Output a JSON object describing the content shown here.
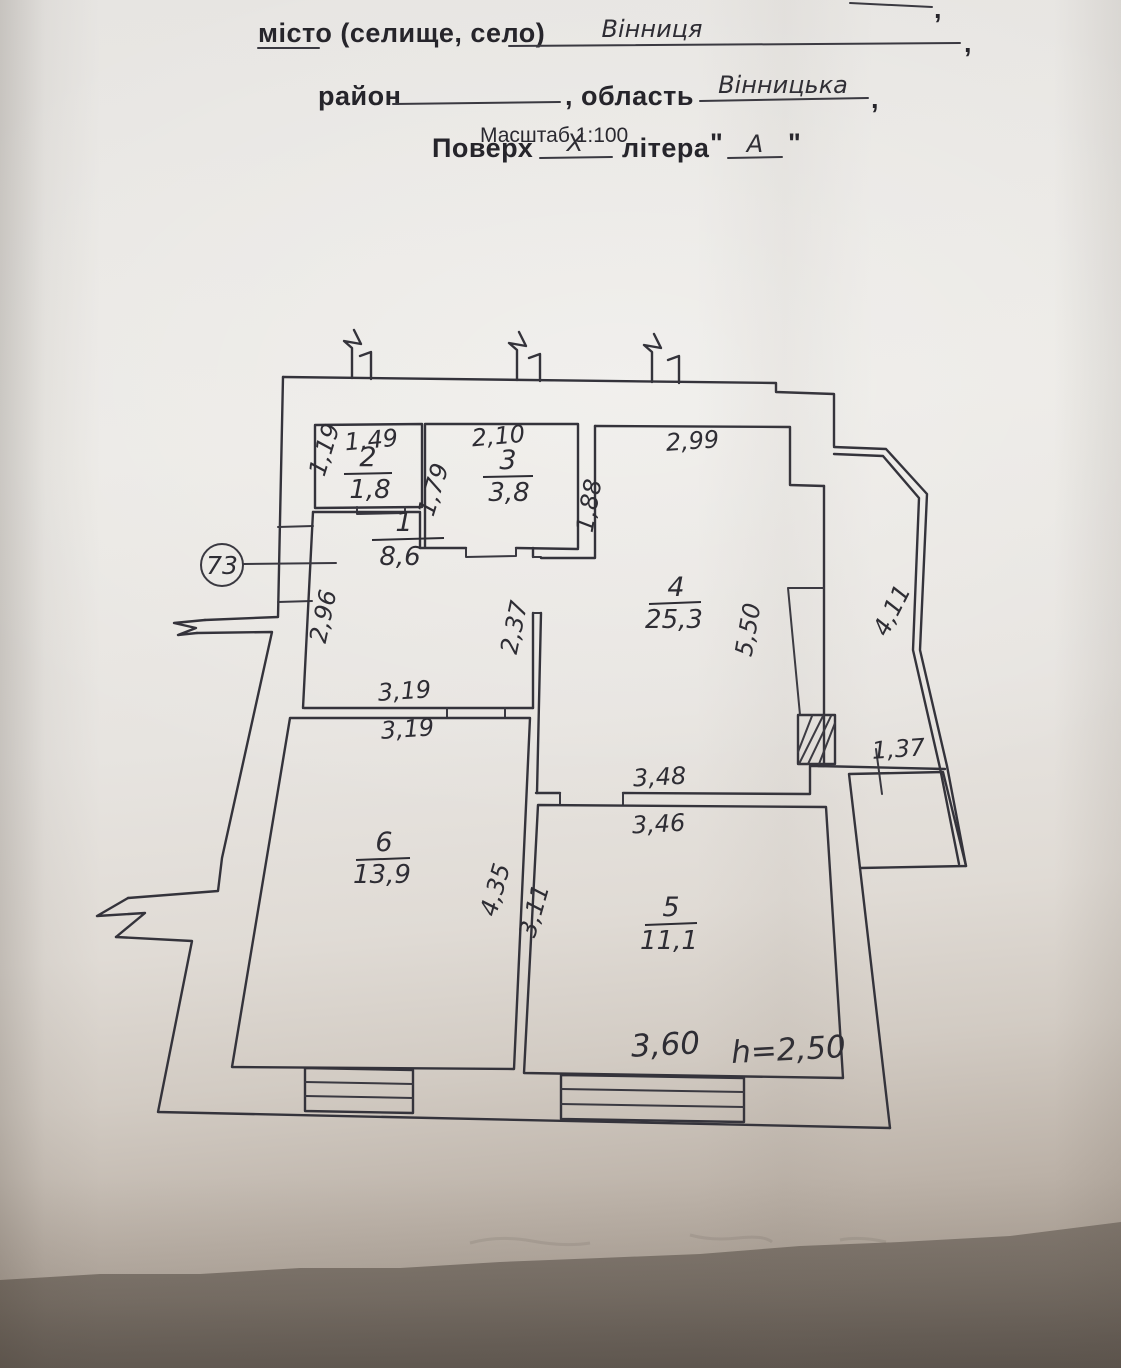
{
  "header": {
    "top_partial_comma": ",",
    "city_label": "місто (селище, село)",
    "city_value": "Вінниця",
    "comma_1": ",",
    "district_label": "район",
    "region_label": ", область",
    "region_value": "Вінницька",
    "comma_2": ",",
    "scale_note": "Масштаб 1:100",
    "floor_label": "Поверх",
    "floor_value": "X",
    "letter_label": "літера",
    "open_quote": "\"",
    "letter_value": "А",
    "close_quote": "\""
  },
  "plan": {
    "apartment_number": "73",
    "rooms": {
      "r1": {
        "number": "1",
        "area": "8,6"
      },
      "r2": {
        "number": "2",
        "area": "1,8"
      },
      "r3": {
        "number": "3",
        "area": "3,8"
      },
      "r4": {
        "number": "4",
        "area": "25,3"
      },
      "r5": {
        "number": "5",
        "area": "11,1"
      },
      "r6": {
        "number": "6",
        "area": "13,9"
      }
    },
    "dims": {
      "room2_top": "1,49",
      "room2_left": "1,19",
      "room3_top": "2,10",
      "room3_left": "1,79",
      "room4_left": "1,88",
      "room4_top": "2,99",
      "room4_right": "5,50",
      "room4_bottom": "3,48",
      "balcony_side": "4,11",
      "hall_left": "2,96",
      "hall_right": "2,37",
      "hall_width": "3,19",
      "room6_width": "3,19",
      "room6_right": "4,35",
      "room5_left": "3,11",
      "room5_top": "3,46",
      "room5_bottom": "3,60",
      "ceiling_height": "h=2,50",
      "balcony_small": "1,37"
    }
  }
}
